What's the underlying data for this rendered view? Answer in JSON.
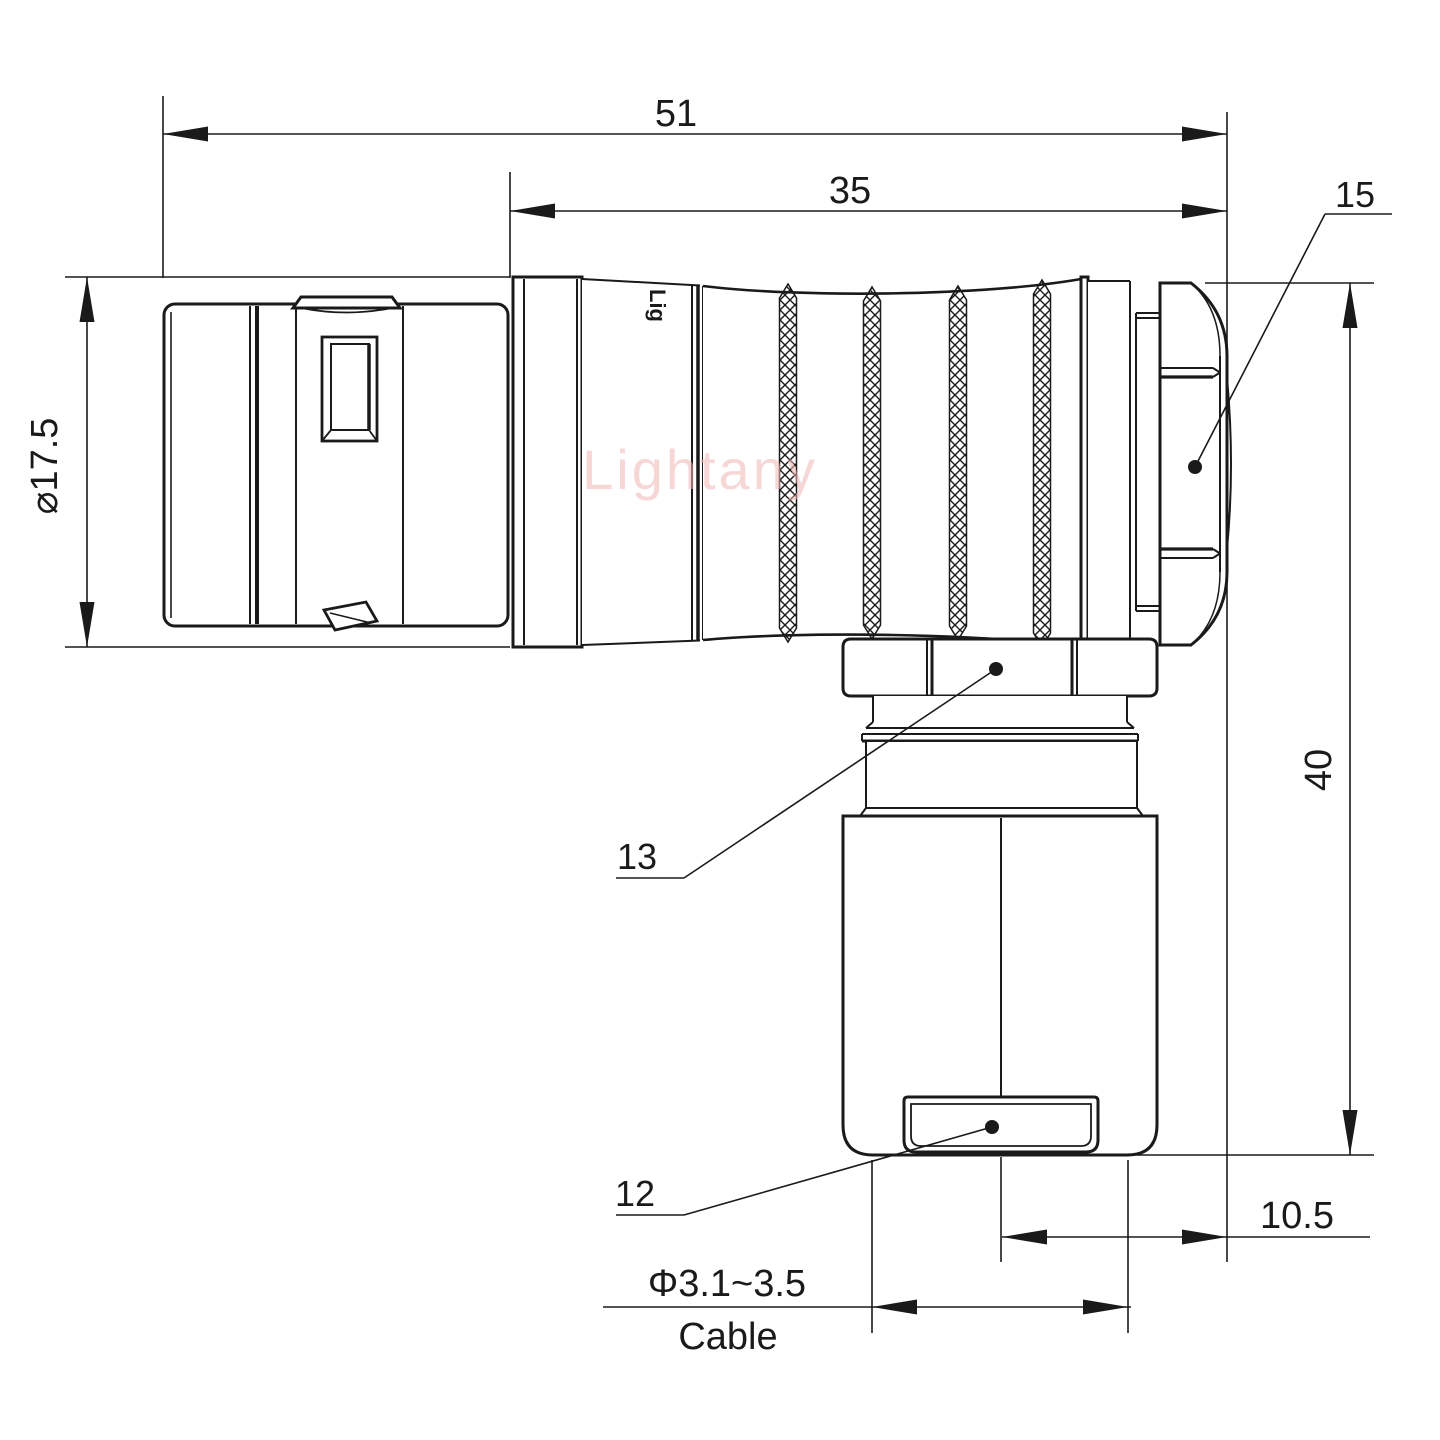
{
  "drawing": {
    "type": "connector-dimension-drawing",
    "watermark": "Lightany",
    "body_marking": "Lig",
    "dims": {
      "overall_length": "51",
      "rear_length": "35",
      "front_diameter": "⌀17.5",
      "height": "40",
      "offset": "10.5",
      "cable_range": "Φ3.1~3.5",
      "cable_word": "Cable"
    },
    "callouts": {
      "backnut": "15",
      "coupling_nut": "13",
      "cable_bushing": "12"
    },
    "colors": {
      "line": "#1a1a1a",
      "watermark": "#f2b6b6",
      "background": "#ffffff"
    }
  }
}
